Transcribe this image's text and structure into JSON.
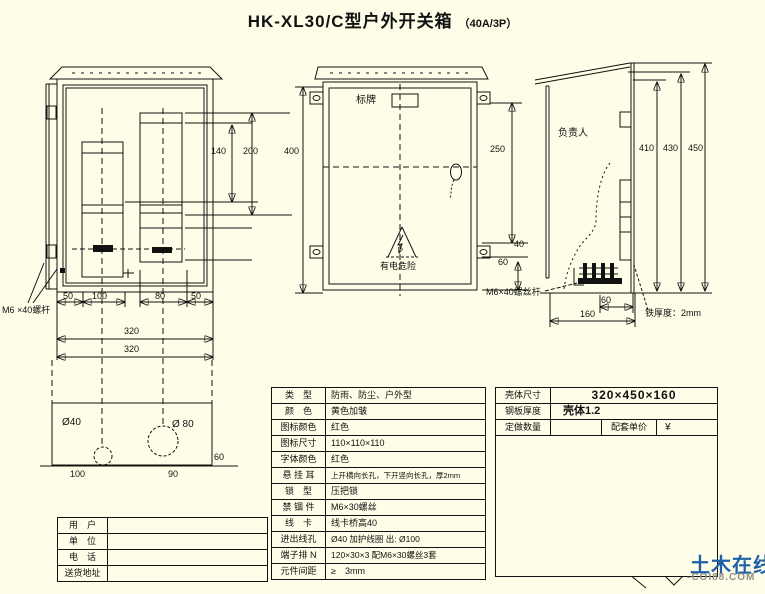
{
  "title": {
    "main": "HK-XL30/C型户外开关箱",
    "sub": "（40A/3P）"
  },
  "front_view": {
    "bolt_label": "M6 ×40螺杆",
    "dims": {
      "h140": "140",
      "h200": "200",
      "w50a": "50",
      "w100": "100",
      "w80": "80",
      "w50b": "50",
      "w320a": "320",
      "w320b": "320"
    }
  },
  "base_plate": {
    "hole_small": "Ø40",
    "hole_large": "Ø 80",
    "w100": "100",
    "w90": "90",
    "h60": "60"
  },
  "center_view": {
    "nameplate_label": "标牌",
    "warning_label": "有电危险",
    "dims": {
      "h400": "400",
      "h250": "250",
      "h40": "40",
      "h60": "60"
    }
  },
  "side_view": {
    "person_label": "负责人",
    "bolt_label": "M6×40螺丝杆",
    "thickness_label": "铁厚度：2mm",
    "dims": {
      "h410": "410",
      "h430": "430",
      "h450": "450",
      "w60": "60",
      "w160": "160"
    }
  },
  "spec_table": {
    "rows": [
      {
        "label": "类　型",
        "value": "防雨、防尘、户外型"
      },
      {
        "label": "颜　色",
        "value": "黄色加皱"
      },
      {
        "label": "图标颜色",
        "value": "红色"
      },
      {
        "label": "图标尺寸",
        "value": "110×110×110"
      },
      {
        "label": "字体颜色",
        "value": "红色"
      },
      {
        "label": "悬 挂 耳",
        "value": "上开横向长孔，下开竖向长孔，厚2mm"
      },
      {
        "label": "锁　型",
        "value": "压把锁"
      },
      {
        "label": "禁 锢 件",
        "value": "M6×30螺丝"
      },
      {
        "label": "线　卡",
        "value": "线卡桥高40"
      },
      {
        "label": "进出线孔",
        "value": "Ø40 加护线圈 出: Ø100"
      },
      {
        "label": "端子排 N",
        "value": "120×30×3 配M6×30螺丝3套"
      },
      {
        "label": "元件间距",
        "value": "≥　3mm"
      }
    ]
  },
  "order_table": {
    "r1_label": "壳体尺寸",
    "r1_value": "320×450×160",
    "r2_label": "钢板厚度",
    "r2_value": "壳体1.2",
    "r3_label": "定做数量",
    "r3_value": "",
    "r3_label2": "配套单价",
    "r3_value2": "¥",
    "wiring_label": "接线图:"
  },
  "wiring": {
    "line1": "DZ20Y-40/3300 （透明空开）",
    "line2": "40A",
    "line3": "DZ15LE-40/4901(3902)（漏保）",
    "line4": "40A　（30MA 0.1S）",
    "pe": "PE"
  },
  "contact_table": {
    "rows": [
      {
        "label": "用　户",
        "value": ""
      },
      {
        "label": "单　位",
        "value": ""
      },
      {
        "label": "电　话",
        "value": ""
      },
      {
        "label": "送货地址",
        "value": ""
      }
    ]
  },
  "watermark": {
    "name": "土木在线",
    "site": "-COI88.COM"
  },
  "colors": {
    "background": "#fefee8",
    "line": "#111111",
    "red": "#cc1111",
    "logo_blue": "#1d5fa8",
    "logo_green": "#8cc11f",
    "logo_gray": "#b5b5ad"
  }
}
